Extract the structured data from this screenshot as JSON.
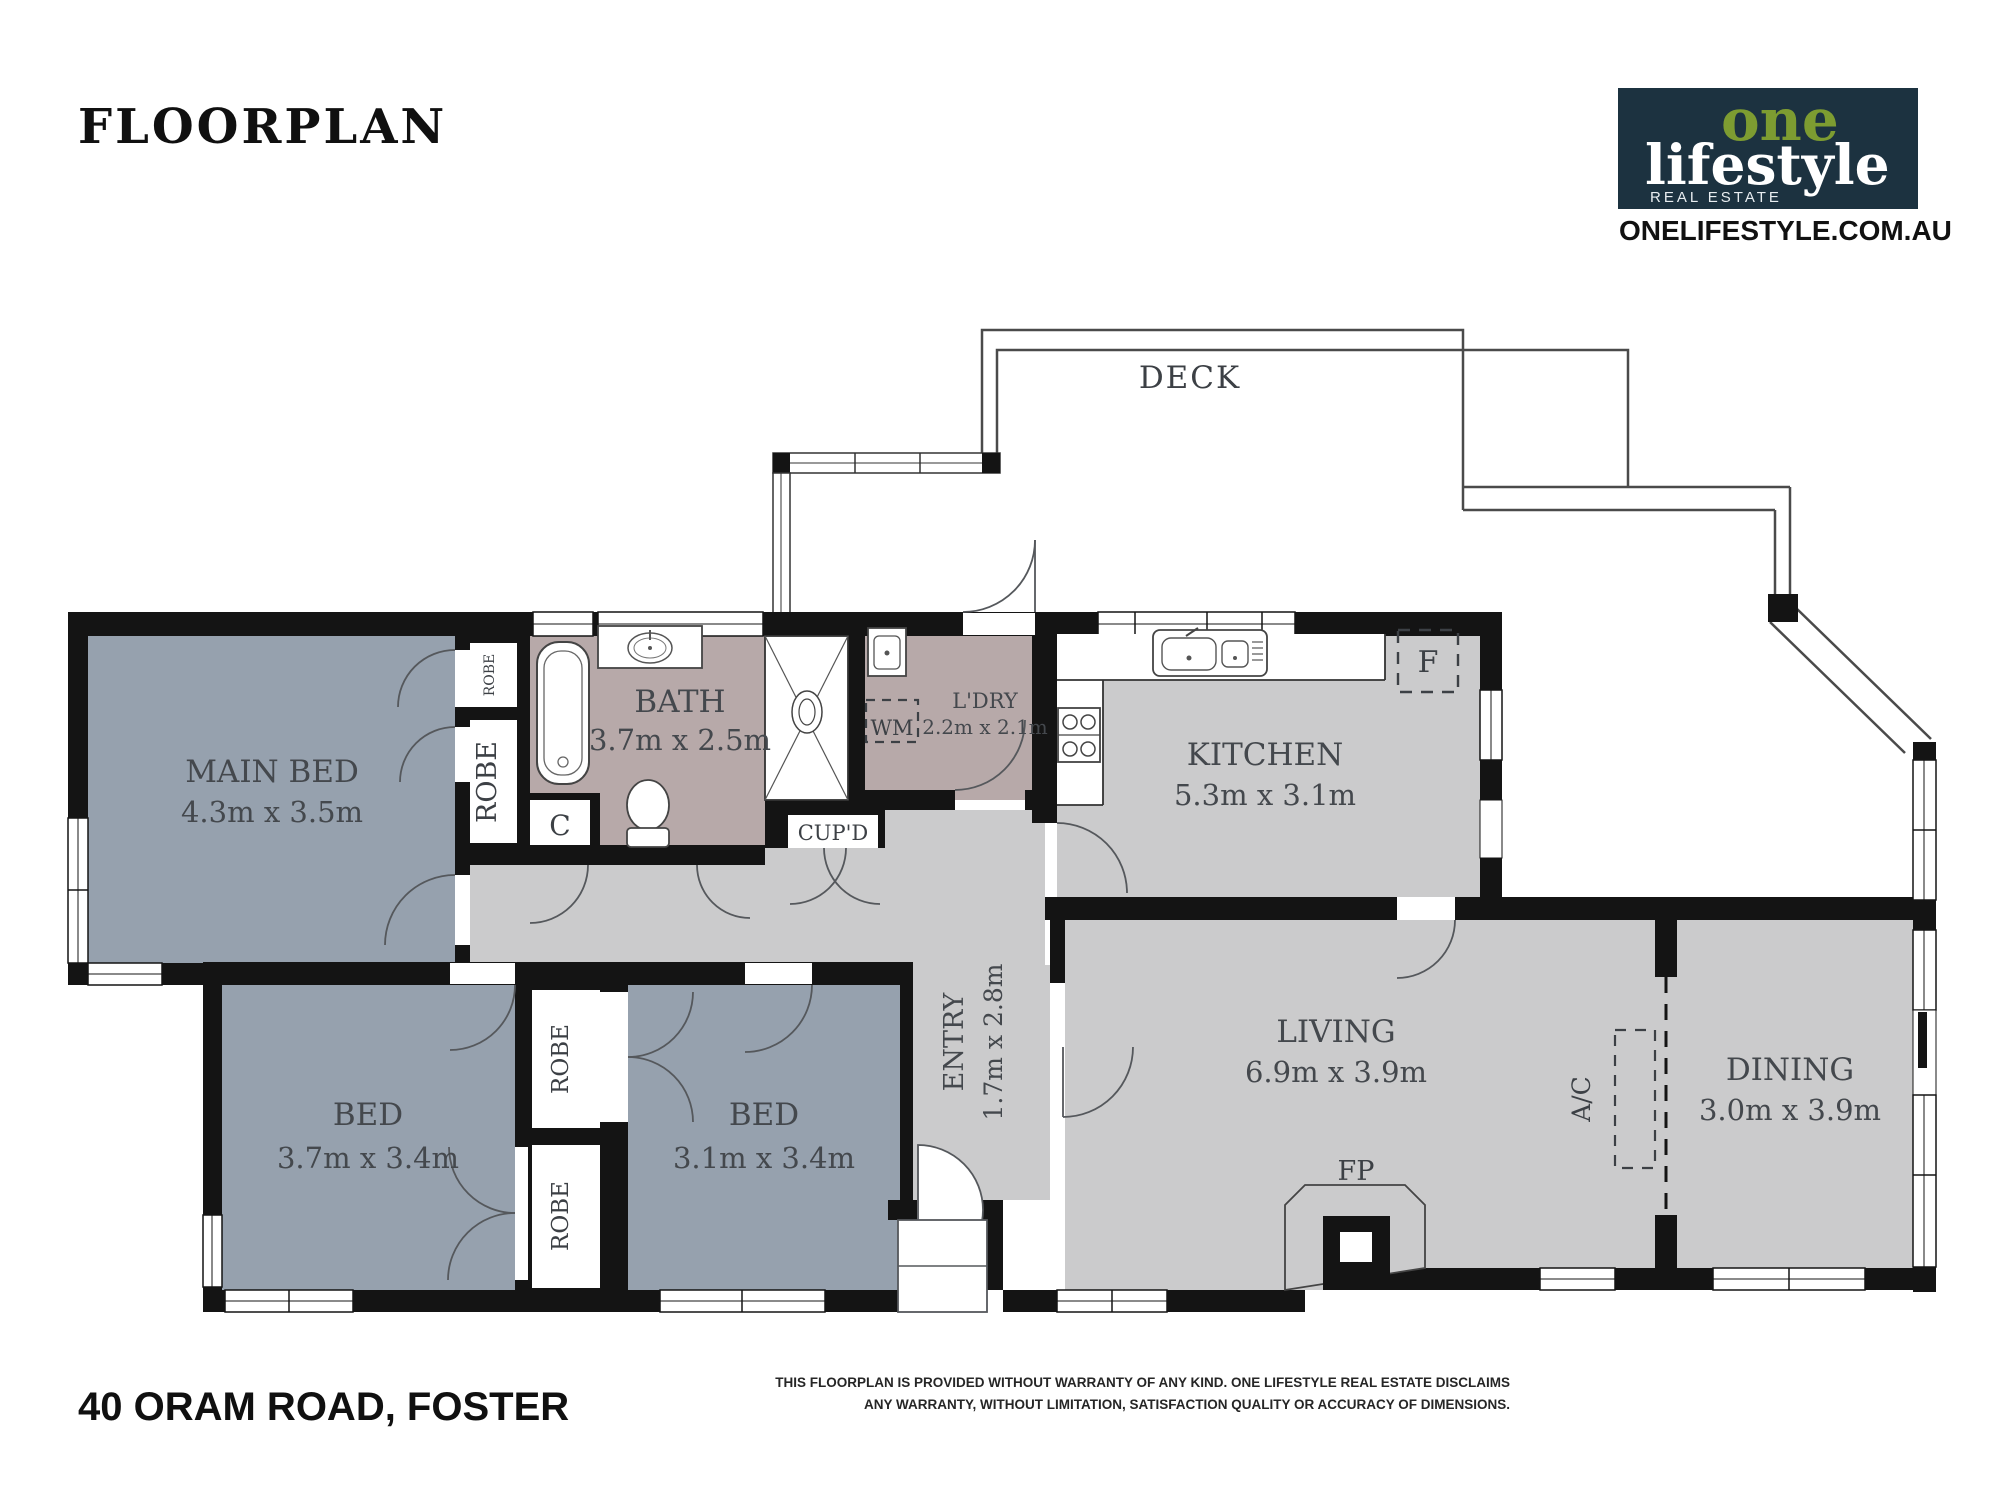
{
  "header": {
    "title": "FLOORPLAN",
    "logo": {
      "one": "one",
      "lifestyle": "lifestyle",
      "tagline": "REAL ESTATE",
      "website": "ONELIFESTYLE.COM.AU",
      "navy": "#1c3240",
      "green": "#7d9c31"
    }
  },
  "plan": {
    "deck": {
      "name": "DECK"
    },
    "main_bed": {
      "name": "MAIN BED",
      "dims": "4.3m x 3.5m"
    },
    "bath": {
      "name": "BATH",
      "dims": "3.7m x 2.5m"
    },
    "laundry": {
      "name": "L'DRY",
      "dims": "2.2m x 2.1m"
    },
    "kitchen": {
      "name": "KITCHEN",
      "dims": "5.3m x 3.1m"
    },
    "living": {
      "name": "LIVING",
      "dims": "6.9m x 3.9m"
    },
    "dining": {
      "name": "DINING",
      "dims": "3.0m x 3.9m"
    },
    "entry": {
      "name": "ENTRY",
      "dims": "1.7m x 2.8m"
    },
    "bed2": {
      "name": "BED",
      "dims": "3.7m x 3.4m"
    },
    "bed3": {
      "name": "BED",
      "dims": "3.1m x 3.4m"
    }
  },
  "fixtures": {
    "fireplace": "FP",
    "air_conditioner": "A/C",
    "fridge": "F",
    "washing_machine": "WM",
    "cupboard_small": "C",
    "cupboard": "CUP'D",
    "robe": "ROBE"
  },
  "footer": {
    "address": "40 ORAM ROAD, FOSTER",
    "disclaimer1": "THIS FLOORPLAN IS PROVIDED WITHOUT WARRANTY OF ANY KIND. ONE LIFESTYLE REAL ESTATE DISCLAIMS",
    "disclaimer2": "ANY WARRANTY, WITHOUT LIMITATION, SATISFACTION QUALITY OR ACCURACY OF DIMENSIONS."
  },
  "colors": {
    "wall": "#141414",
    "bedroom_fill": "#96a1ae",
    "common_fill": "#cbcbcc",
    "wet_area_fill": "#b7a9a9",
    "outline": "#4a4a4a"
  }
}
